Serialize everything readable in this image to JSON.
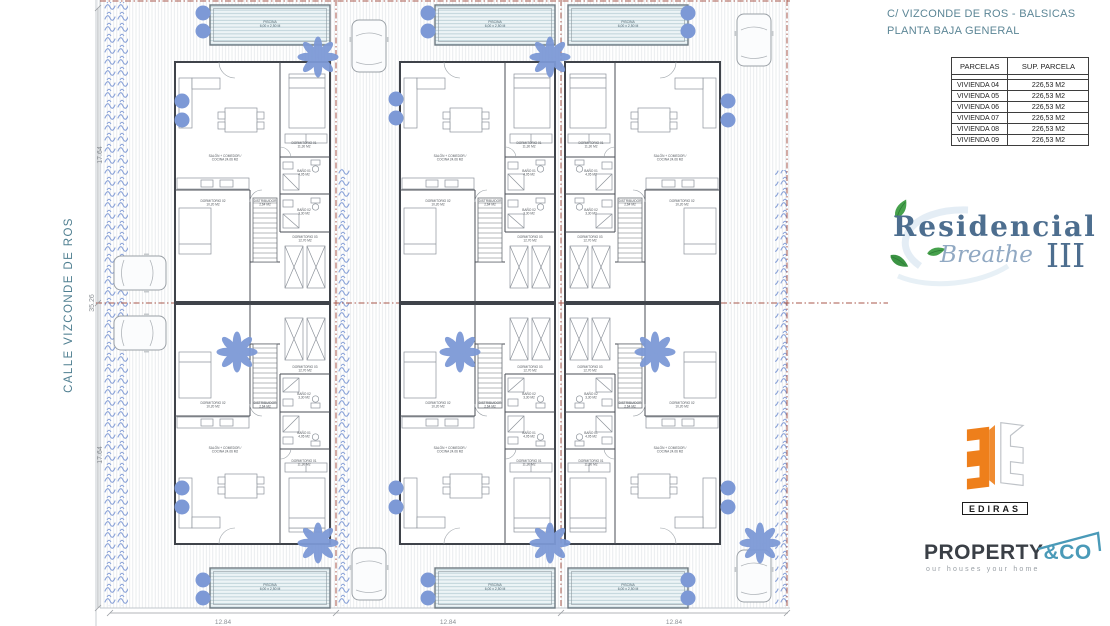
{
  "titleblock": {
    "line1": "C/ VIZCONDE DE ROS - BALSICAS",
    "line2": "PLANTA BAJA GENERAL"
  },
  "table": {
    "headers": [
      "PARCELAS",
      "SUP. PARCELA"
    ],
    "rows": [
      [
        "VIVIENDA 04",
        "226,53 M2"
      ],
      [
        "VIVIENDA 05",
        "226,53 M2"
      ],
      [
        "VIVIENDA 06",
        "226,53 M2"
      ],
      [
        "VIVIENDA 07",
        "226,53 M2"
      ],
      [
        "VIVIENDA 08",
        "226,53 M2"
      ],
      [
        "VIVIENDA 09",
        "226,53 M2"
      ]
    ]
  },
  "plan": {
    "street_label": "CALLE VIZCONDE DE ROS",
    "dim_left_top": "17.64",
    "dim_left_total": "35.26",
    "dim_left_bottom": "17.64",
    "dim_bottom": [
      "12.84",
      "12.84",
      "12.84"
    ],
    "pool_label": [
      "PISCINA",
      "6,00 x 2,50 M"
    ],
    "room_labels": [
      {
        "t": [
          "SALÓN + COMEDOR /",
          "COCINA  24,06 M2"
        ],
        "x": 50,
        "y": 95
      },
      {
        "t": [
          "DORMITORIO 01",
          "11,30 M2"
        ],
        "x": 129,
        "y": 82
      },
      {
        "t": [
          "BAÑO 01",
          "4,05 M2"
        ],
        "x": 129,
        "y": 110
      },
      {
        "t": [
          "BAÑO 02",
          "3,30 M2"
        ],
        "x": 129,
        "y": 149
      },
      {
        "t": [
          "DISTRIBUIDOR",
          "2,64 M2"
        ],
        "x": 90,
        "y": 140
      },
      {
        "t": [
          "DORMITORIO 02",
          "10,20 M2"
        ],
        "x": 38,
        "y": 140
      },
      {
        "t": [
          "DORMITORIO 03",
          "12,70 M2"
        ],
        "x": 130,
        "y": 176
      }
    ],
    "units": [
      {
        "x": 175,
        "y": 62,
        "mx": 1,
        "my": 1
      },
      {
        "x": 400,
        "y": 62,
        "mx": 1,
        "my": 1
      },
      {
        "x": 720,
        "y": 62,
        "mx": -1,
        "my": 1
      },
      {
        "x": 175,
        "y": 544,
        "mx": 1,
        "my": -1
      },
      {
        "x": 400,
        "y": 544,
        "mx": 1,
        "my": -1
      },
      {
        "x": 720,
        "y": 544,
        "mx": -1,
        "my": -1
      }
    ],
    "pools": [
      {
        "x": 210,
        "y": 5
      },
      {
        "x": 435,
        "y": 5
      },
      {
        "x": 568,
        "y": 5
      },
      {
        "x": 210,
        "y": 568
      },
      {
        "x": 435,
        "y": 568
      },
      {
        "x": 568,
        "y": 568
      }
    ],
    "cars": [
      [
        369,
        46,
        0
      ],
      [
        754,
        40,
        0
      ],
      [
        369,
        574,
        0
      ],
      [
        754,
        576,
        0
      ],
      [
        140,
        273,
        90
      ],
      [
        140,
        333,
        90
      ]
    ],
    "trees": [
      [
        318,
        57
      ],
      [
        550,
        57
      ],
      [
        237,
        352
      ],
      [
        460,
        352
      ],
      [
        655,
        352
      ],
      [
        318,
        543
      ],
      [
        550,
        543
      ],
      [
        760,
        543
      ]
    ],
    "bushes": [
      [
        203,
        13
      ],
      [
        203,
        31
      ],
      [
        182,
        101
      ],
      [
        182,
        120
      ],
      [
        428,
        13
      ],
      [
        428,
        31
      ],
      [
        396,
        99
      ],
      [
        396,
        118
      ],
      [
        688,
        13
      ],
      [
        688,
        31
      ],
      [
        728,
        101
      ],
      [
        728,
        120
      ],
      [
        203,
        580
      ],
      [
        203,
        598
      ],
      [
        182,
        488
      ],
      [
        182,
        507
      ],
      [
        428,
        580
      ],
      [
        428,
        598
      ],
      [
        396,
        488
      ],
      [
        396,
        507
      ],
      [
        688,
        580
      ],
      [
        688,
        598
      ],
      [
        728,
        488
      ],
      [
        728,
        507
      ]
    ],
    "colors": {
      "vegetation": "#7d99d6",
      "boundary": "#a8574b",
      "heading": "#5c8696"
    }
  },
  "logos": {
    "residencial": {
      "line1": "Residencial",
      "line2": "Breathe",
      "numeral": "III"
    },
    "ediras": {
      "name": "EDIRAS"
    },
    "property": {
      "part1": "PROPERTY",
      "part2": "&CO",
      "tagline": "our houses your home"
    }
  }
}
